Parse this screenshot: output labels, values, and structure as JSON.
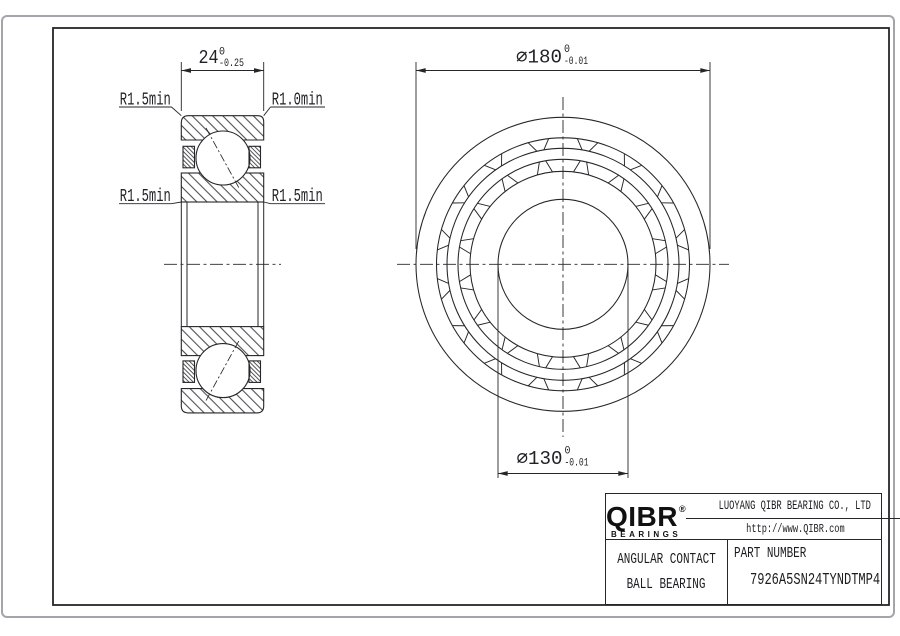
{
  "section_view": {
    "width_dim": {
      "value": "24",
      "tol_upper": "0",
      "tol_lower": "-0.25"
    },
    "fillet_labels": {
      "top_left": "R1.5min",
      "top_right": "R1.0min",
      "bottom_left": "R1.5min",
      "bottom_right": "R1.5min"
    }
  },
  "front_view": {
    "outer_dia_dim": {
      "value": "⌀180",
      "tol_upper": "0",
      "tol_lower": "-0.01"
    },
    "bore_dia_dim": {
      "value": "⌀130",
      "tol_upper": "0",
      "tol_lower": "-0.01"
    }
  },
  "title_block": {
    "logo_text": "QIBR",
    "logo_registered": "®",
    "logo_subtext": "BEARINGS",
    "company_name": "LUOYANG QIBR BEARING CO., LTD",
    "website": "http://www.QIBR.com",
    "product_line1": "ANGULAR CONTACT",
    "product_line2": "BALL BEARING",
    "part_number_label": "PART NUMBER",
    "part_number": "7926A5SN24TYNDTMP4"
  }
}
